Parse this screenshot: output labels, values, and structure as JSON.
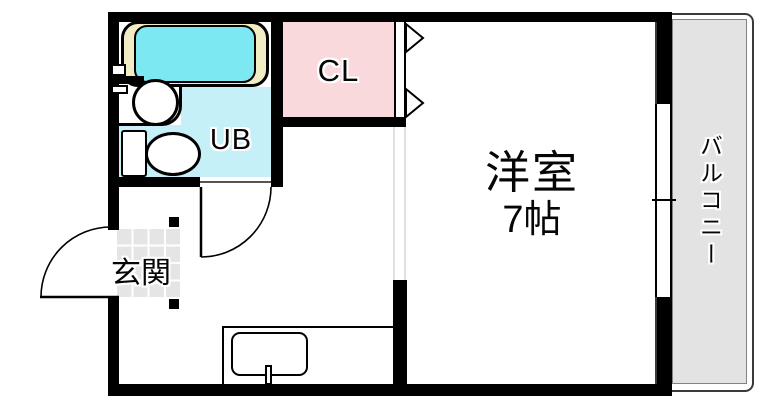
{
  "floorplan": {
    "rooms": {
      "closet": {
        "label": "CL"
      },
      "unit_bath": {
        "label": "UB"
      },
      "entrance": {
        "label": "玄関"
      },
      "main_room": {
        "label": "洋室",
        "size": "7帖"
      },
      "balcony": {
        "label": "バルコニー"
      }
    },
    "fixtures": {
      "bathtub": "bathtub-icon",
      "washbasin": "washbasin-icon",
      "toilet": "toilet-icon",
      "kitchen_sink": "kitchen-sink-icon",
      "entrance_door": "swing-door-icon",
      "unit_bath_door": "swing-door-icon",
      "closet_door": "folding-door-icon",
      "balcony_window": "sliding-window-icon"
    },
    "colors": {
      "wall": "#000000",
      "closet_fill": "#fad9dc",
      "unit_bath_fill": "#c5f0f7",
      "bathtub_water": "#7be8f2",
      "bathtub_rim": "#f2ecc4",
      "balcony_fill": "#e3e3e3",
      "entrance_tile_fill": "#e5e5e5"
    }
  }
}
